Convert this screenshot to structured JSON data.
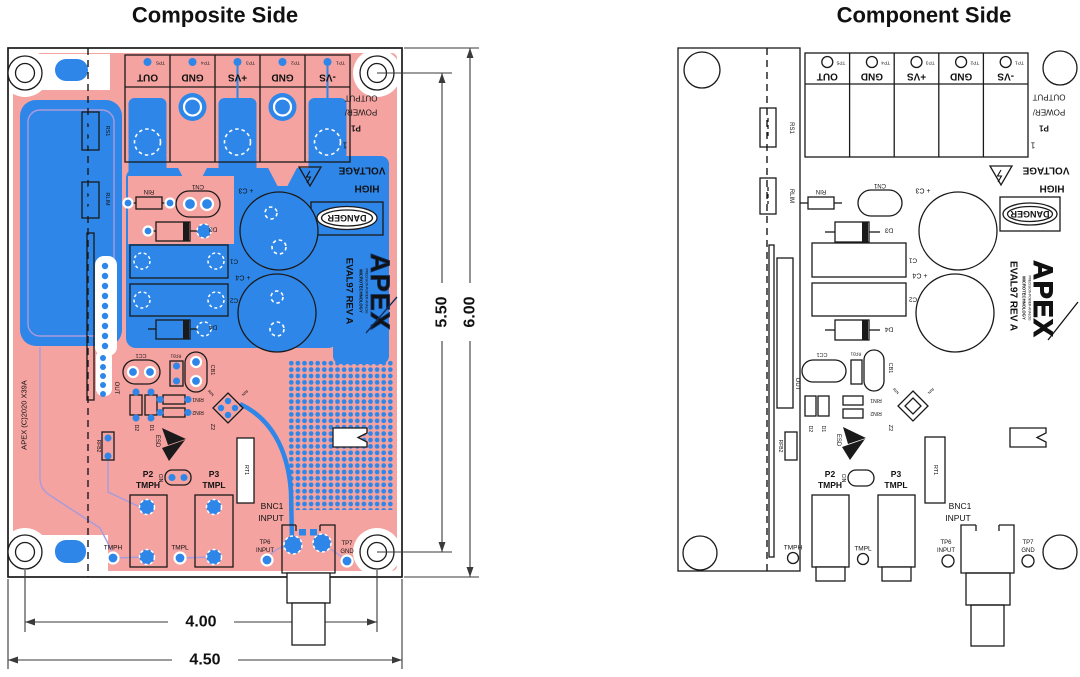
{
  "titles": {
    "left": "Composite Side",
    "right": "Component Side"
  },
  "dims": {
    "outer_h": "6.00",
    "inner_h": "5.50",
    "inner_w": "4.00",
    "outer_w": "4.50"
  },
  "terminals": [
    {
      "tp": "TP5",
      "name": "OUT"
    },
    {
      "tp": "TP4",
      "name": "GND"
    },
    {
      "tp": "TP3",
      "name": "+VS"
    },
    {
      "tp": "TP2",
      "name": "GND"
    },
    {
      "tp": "TP1",
      "name": "-VS"
    }
  ],
  "conn": {
    "out": "OUTPUT",
    "pwr": "POWER/",
    "ref": "P1",
    "pin": "1"
  },
  "warn": {
    "high": "HIGH",
    "voltage": "VOLTAGE",
    "danger": "DANGER"
  },
  "brand": {
    "eval": "EVAL97  REV A",
    "apex": "APEX",
    "micro": "MICROTECHNOLOGY",
    "ppa": "PRECISION-POWER-ANALOG",
    "copy": "APEX (C)2020 X39A"
  },
  "refs": {
    "rs1": "RS1",
    "rlim": "RLIM",
    "rin": "RIN",
    "cn1": "CN1",
    "d3": "D3",
    "c1": "C1",
    "c2": "C2",
    "d4": "D4",
    "c3": "+ C3",
    "c4": "+ C4",
    "cc1": "CC1",
    "rfb1": "RFB1",
    "cb1": "CB1",
    "out": "OUT",
    "d1": "D1",
    "d2": "D2",
    "rin1": "RIN1",
    "rin2": "RIN2",
    "z2": "Z2",
    "esd": "ESD",
    "cin": "CIN",
    "rfb2": "RFB2",
    "rt1": "RT1"
  },
  "io": {
    "p2": "P2",
    "p2_net": "TMPH",
    "p3": "P3",
    "p3_net": "TMPL",
    "tmph": "TMPH",
    "tmpl": "TMPL",
    "bnc": "BNC1",
    "bnc_net": "INPUT",
    "tp6": "TP6",
    "tp6_net": "INPUT",
    "tp7": "TP7",
    "tp7_net": "GND"
  },
  "colors": {
    "copper_bottom": "#F4A3A0",
    "copper_top": "#2E86E8",
    "trace": "#A89BDB",
    "silkscreen": "#1A1A1A"
  }
}
